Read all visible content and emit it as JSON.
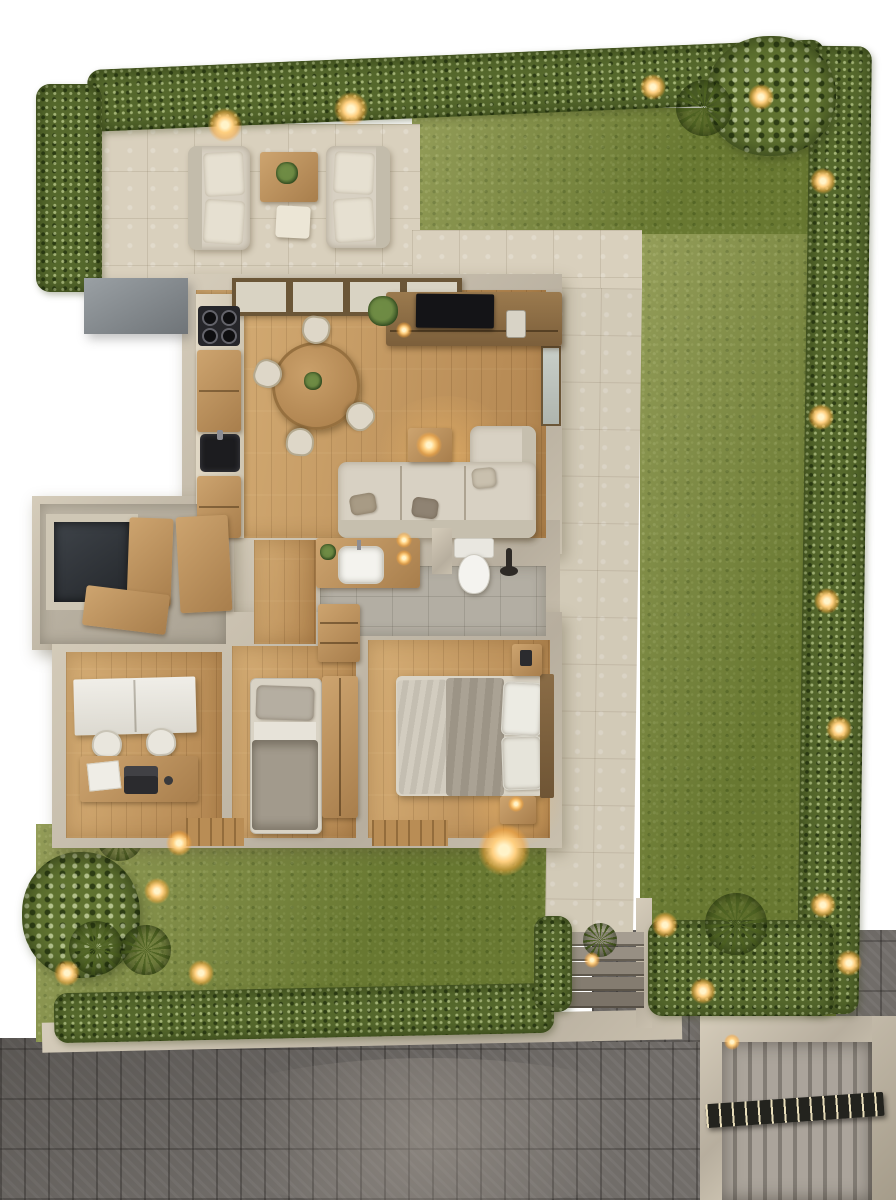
{
  "scene": {
    "title": "Top-down 3D architectural render of a single-storey house with furnished rooms, patio, lawn and street",
    "lighting": "dusk with warm garden and interior lights"
  },
  "palette": {
    "background": "#ffffff",
    "grass": "#76853a",
    "hedge": "#55682c",
    "stone": "#d9d0bd",
    "tile": "#b3aea3",
    "wood": "#c69a62",
    "wall": "#d5ccba",
    "wall-shadow": "#b7ae9e",
    "street": "#716d69",
    "glow": "#ffcf7f",
    "dark": "#222225"
  },
  "outdoor": {
    "patio": {
      "label": "Patio lounge with two outdoor sofas, wooden coffee table and plant",
      "sofas": 2
    },
    "lawn": {
      "label": "Main lawn"
    },
    "hedge": {
      "label": "Perimeter hedge with warm garden lights"
    },
    "tree_corner": {
      "label": "Tree at top-right hedge corner"
    },
    "garden": {
      "label": "Lower garden with tree, agave plants and spot lights"
    },
    "path": {
      "label": "Stone side path along the house"
    },
    "steps": {
      "label": "Stone entry steps",
      "treads": 5
    },
    "driveway": {
      "label": "Grey block-paved street"
    },
    "gate": {
      "label": "Louvred carport roof with slatted beam and wall light"
    },
    "curb": {
      "label": "Concrete curb"
    }
  },
  "rooms": {
    "kitchen": {
      "label": "Kitchen with wall counter, 4-burner cooktop and dark sink",
      "burners": 4
    },
    "dining": {
      "label": "Dining area with round wooden table and chairs",
      "chairs": 4
    },
    "living": {
      "label": "Living room with TV sideboard, L-shaped sofa and lit lamp"
    },
    "bathroom": {
      "label": "Bathroom with wooden vanity, white basin, toilet and two wall sconces",
      "sconces": 2
    },
    "hallway": {
      "label": "Hallway with wooden floor"
    },
    "entry": {
      "label": "Entry / utility with dark lightwell and open wooden doors"
    },
    "office": {
      "label": "Home office with white cabinet, desk, laptop and two chairs",
      "chairs": 2
    },
    "bedroom_single": {
      "label": "Single bedroom with grey bedding and wardrobe"
    },
    "bedroom_double": {
      "label": "Main bedroom with double bed, pillows, nightstand and lit lamp",
      "pillows": 2
    }
  }
}
